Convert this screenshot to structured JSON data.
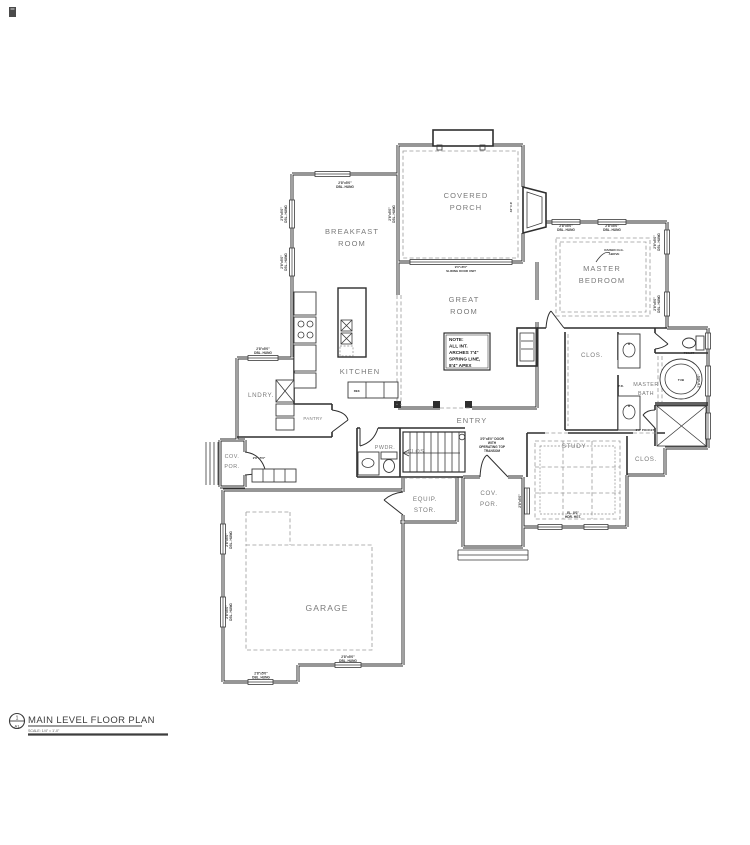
{
  "drawing": {
    "type": "architectural floor plan",
    "background": "#ffffff"
  },
  "colors": {
    "wall_line": "#2e2e2e",
    "dashed_line": "#9a9a9a",
    "room_label": "#7a7a7a",
    "tiny_text": "#2f2f2f",
    "title_text": "#3d3d3d"
  },
  "title_block": {
    "symbol_top": "1",
    "symbol_bottom": "A1",
    "title": "MAIN LEVEL FLOOR PLAN",
    "scale": "SCALE: 1/4\" = 1'-0\""
  },
  "rooms": {
    "breakfast_1": "BREAKFAST",
    "breakfast_2": "ROOM",
    "covered_porch_1": "COVERED",
    "covered_porch_2": "PORCH",
    "great_1": "GREAT",
    "great_2": "ROOM",
    "master_bed_1": "MASTER",
    "master_bed_2": "BEDROOM",
    "kitchen": "KITCHEN",
    "lndry": "LNDRY.",
    "pantry": "PANTRY",
    "clos": "CLOS.",
    "master_bath_1": "MASTER",
    "master_bath_2": "BATH",
    "toilet": "TOILET",
    "tub": "TUB",
    "entry": "ENTRY",
    "pwdr": "PWDR.",
    "study": "STUDY",
    "cov_por_1": "COV.",
    "cov_por_2": "POR.",
    "equip_1": "EQUIP.",
    "equip_2": "STOR.",
    "garage": "GARAGE"
  },
  "note_box": {
    "l1": "NOTE:",
    "l2": "ALL INT.",
    "l3": "ARCHES 7'4\"",
    "l4": "SPRING LINE,",
    "l5": "8'4\" APEX"
  },
  "door_note": {
    "l1": "3'0\"x8'0\" DOOR",
    "l2": "WITH",
    "l3": "OPERATING TOP",
    "l4": "TRANSOM"
  },
  "tiny": {
    "win1": "2'8\"x5'0\"",
    "win2": "DBL. HUNG",
    "slider1": "9'0\"x8'0\"",
    "slider2": "SLIDING DOOR UNIT",
    "raised1": "RAISED CLG.",
    "raised2": "ABOVE",
    "hdr1": "EL. 8'0\"",
    "hdr2": "HDR. HGT.",
    "pocket": "3'0\" POCKET",
    "pd": "P.D.",
    "fp": "42\" F.P.",
    "ref": "REF."
  }
}
